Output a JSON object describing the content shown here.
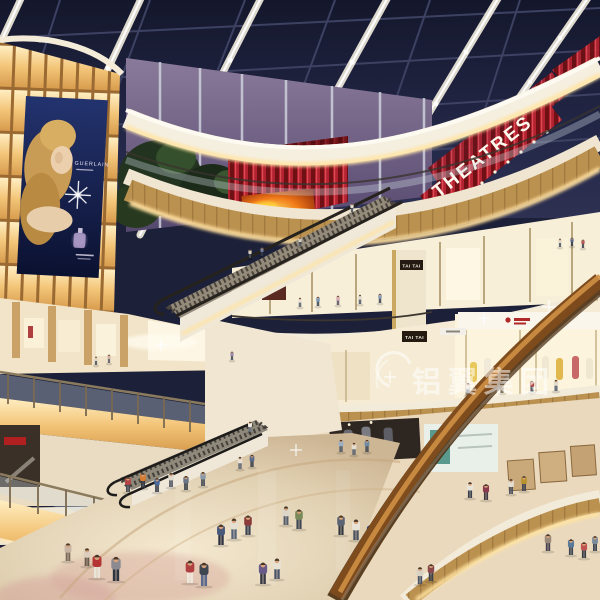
{
  "meta": {
    "description": "Photorealistic architectural rendering of a multi-level shopping mall atrium at dusk: glass skylight, curved balconies, escalators, glowing advertising wall, cinema level and crowds of shoppers",
    "width": 600,
    "height": 600
  },
  "scene": {
    "signs": {
      "theatres": "THEATRES",
      "tai_tai_upper": "TAI TAI",
      "tai_tai_lower": "TAI TAI"
    },
    "billboard": {
      "brand": "GUERLAIN"
    },
    "watermark": {
      "text": "铝翼集团"
    },
    "palette": {
      "sky": "#1c2038",
      "beam": "#f4efe0",
      "red_sign": "#b22230",
      "cream": "#f3ebda",
      "wood": "#bb9150",
      "cove_glow": "#ffe5a8",
      "amber_wall": "#f3c578",
      "floor": "#e6d7ba",
      "fire_screen": "#f07818",
      "poster_navy": "#16204a",
      "dusk_glass": "#75668a"
    },
    "people_format": [
      "x",
      "y",
      "h",
      "shirt_color",
      "pants_color"
    ],
    "people": [
      [
        97,
        578,
        25,
        "#b53434",
        "#e9e4d8"
      ],
      [
        116,
        581,
        26,
        "#8a8a90",
        "#2e3440"
      ],
      [
        190,
        583,
        24,
        "#b04040",
        "#efe9dd"
      ],
      [
        204,
        586,
        25,
        "#3e4450",
        "#5b6a8a"
      ],
      [
        263,
        584,
        23,
        "#6a5a88",
        "#3a3a46"
      ],
      [
        277,
        579,
        22,
        "#e8e2d4",
        "#4a5468"
      ],
      [
        221,
        545,
        22,
        "#49597a",
        "#2c3240"
      ],
      [
        234,
        539,
        22,
        "#e5dfd2",
        "#5a6478"
      ],
      [
        248,
        535,
        21,
        "#8a3a3a",
        "#3c4252"
      ],
      [
        371,
        546,
        23,
        "#2e4a8e",
        "#28303e"
      ],
      [
        356,
        540,
        22,
        "#e8e4d8",
        "#4a525f"
      ],
      [
        341,
        535,
        21,
        "#5a6472",
        "#33383f"
      ],
      [
        299,
        529,
        21,
        "#7a8a58",
        "#3f4654"
      ],
      [
        286,
        525,
        20,
        "#dcd6c8",
        "#565e6e"
      ],
      [
        420,
        584,
        18,
        "#d8d2c4",
        "#4a5262"
      ],
      [
        431,
        581,
        18,
        "#8a4a4a",
        "#3a4050"
      ],
      [
        68,
        561,
        19,
        "#c8b4a4",
        "#7a6a5c"
      ],
      [
        87,
        566,
        19,
        "#dccfc0",
        "#6a5a4c"
      ],
      [
        128,
        492,
        16,
        "#b54444",
        "#3e4450"
      ],
      [
        143,
        488,
        16,
        "#d87c32",
        "#2e3440"
      ],
      [
        157,
        492,
        15,
        "#4a6a9a",
        "#303844"
      ],
      [
        171,
        487,
        15,
        "#e0dacc",
        "#4a525e"
      ],
      [
        186,
        490,
        15,
        "#6a7486",
        "#343a44"
      ],
      [
        203,
        486,
        15,
        "#8a9aaa",
        "#3e4450"
      ],
      [
        240,
        469,
        13,
        "#e8e2d6",
        "#5a6270"
      ],
      [
        252,
        467,
        13,
        "#5a6a8a",
        "#323844"
      ],
      [
        341,
        452,
        13,
        "#9ab0c8",
        "#4a5262"
      ],
      [
        354,
        455,
        13,
        "#e4ded0",
        "#566070"
      ],
      [
        367,
        452,
        13,
        "#6a8aa8",
        "#3a4452"
      ],
      [
        250,
        432,
        11,
        "#f0ece2",
        "#6a7484"
      ],
      [
        470,
        498,
        17,
        "#e8e4da",
        "#3a4250"
      ],
      [
        486,
        500,
        17,
        "#8a3a4e",
        "#403a44"
      ],
      [
        511,
        494,
        16,
        "#e5dfd2",
        "#4a525e"
      ],
      [
        524,
        491,
        16,
        "#b8922e",
        "#3e4450"
      ],
      [
        548,
        551,
        18,
        "#9a8878",
        "#474151"
      ],
      [
        571,
        555,
        17,
        "#5a7a9a",
        "#3c444f"
      ],
      [
        584,
        558,
        17,
        "#c05252",
        "#343a46"
      ],
      [
        595,
        551,
        16,
        "#7a8a9a",
        "#3a4050"
      ],
      [
        468,
        395,
        13,
        "#e8e2d4",
        "#5a6472"
      ],
      [
        502,
        393,
        12,
        "#c8b090",
        "#6a5a4a"
      ],
      [
        532,
        392,
        12,
        "#b04848",
        "#3c4450"
      ],
      [
        556,
        391,
        12,
        "#e2dccd",
        "#4e586a"
      ],
      [
        300,
        307,
        10,
        "#e8e4d8",
        "#555f6d"
      ],
      [
        318,
        306,
        10,
        "#7a9ab8",
        "#3a4452"
      ],
      [
        338,
        305,
        10,
        "#d8b0b8",
        "#5a5264"
      ],
      [
        360,
        304,
        10,
        "#e4ded2",
        "#4c5666"
      ],
      [
        380,
        303,
        10,
        "#8aa0b8",
        "#38404e"
      ],
      [
        250,
        258,
        9,
        "#d8d2c4",
        "#4a5260"
      ],
      [
        262,
        256,
        9,
        "#6a7a9a",
        "#343c4a"
      ],
      [
        560,
        247,
        9,
        "#e0dace",
        "#4e5868"
      ],
      [
        572,
        246,
        9,
        "#5a6a8a",
        "#323a48"
      ],
      [
        583,
        248,
        9,
        "#b05050",
        "#3c4250"
      ],
      [
        109,
        363,
        9,
        "#d0b8a8",
        "#5a5a6a"
      ],
      [
        96,
        365,
        9,
        "#e0d8c8",
        "#4a5262"
      ],
      [
        232,
        360,
        9,
        "#9a8ab0",
        "#424a58"
      ],
      [
        352,
        212,
        9,
        "#e8e4da",
        "#4a5260"
      ],
      [
        300,
        246,
        9,
        "#d8d2c6",
        "#505a68"
      ]
    ]
  }
}
